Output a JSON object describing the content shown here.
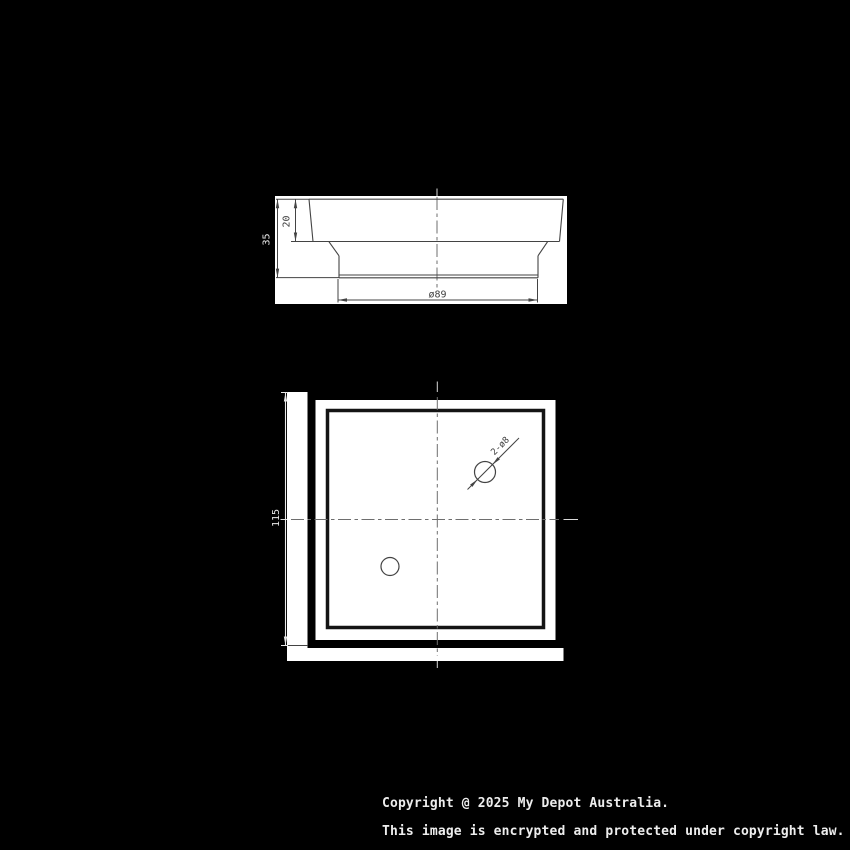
{
  "drawing": {
    "side_view": {
      "overall_height": "35",
      "flange_height": "20",
      "base_diameter": "ø89"
    },
    "plan_view": {
      "overall_width": "115",
      "hole_callout": "2-ø8"
    }
  },
  "footer": {
    "line1": "Copyright @ 2025 My Depot Australia.",
    "line2": "This image is encrypted and protected under copyright law."
  },
  "colors": {
    "background": "#000000",
    "paper_patch": "#ffffff",
    "dark_line": "#3f3f3f",
    "thick_frame": "#000000",
    "white_line": "#e8e8e8"
  }
}
